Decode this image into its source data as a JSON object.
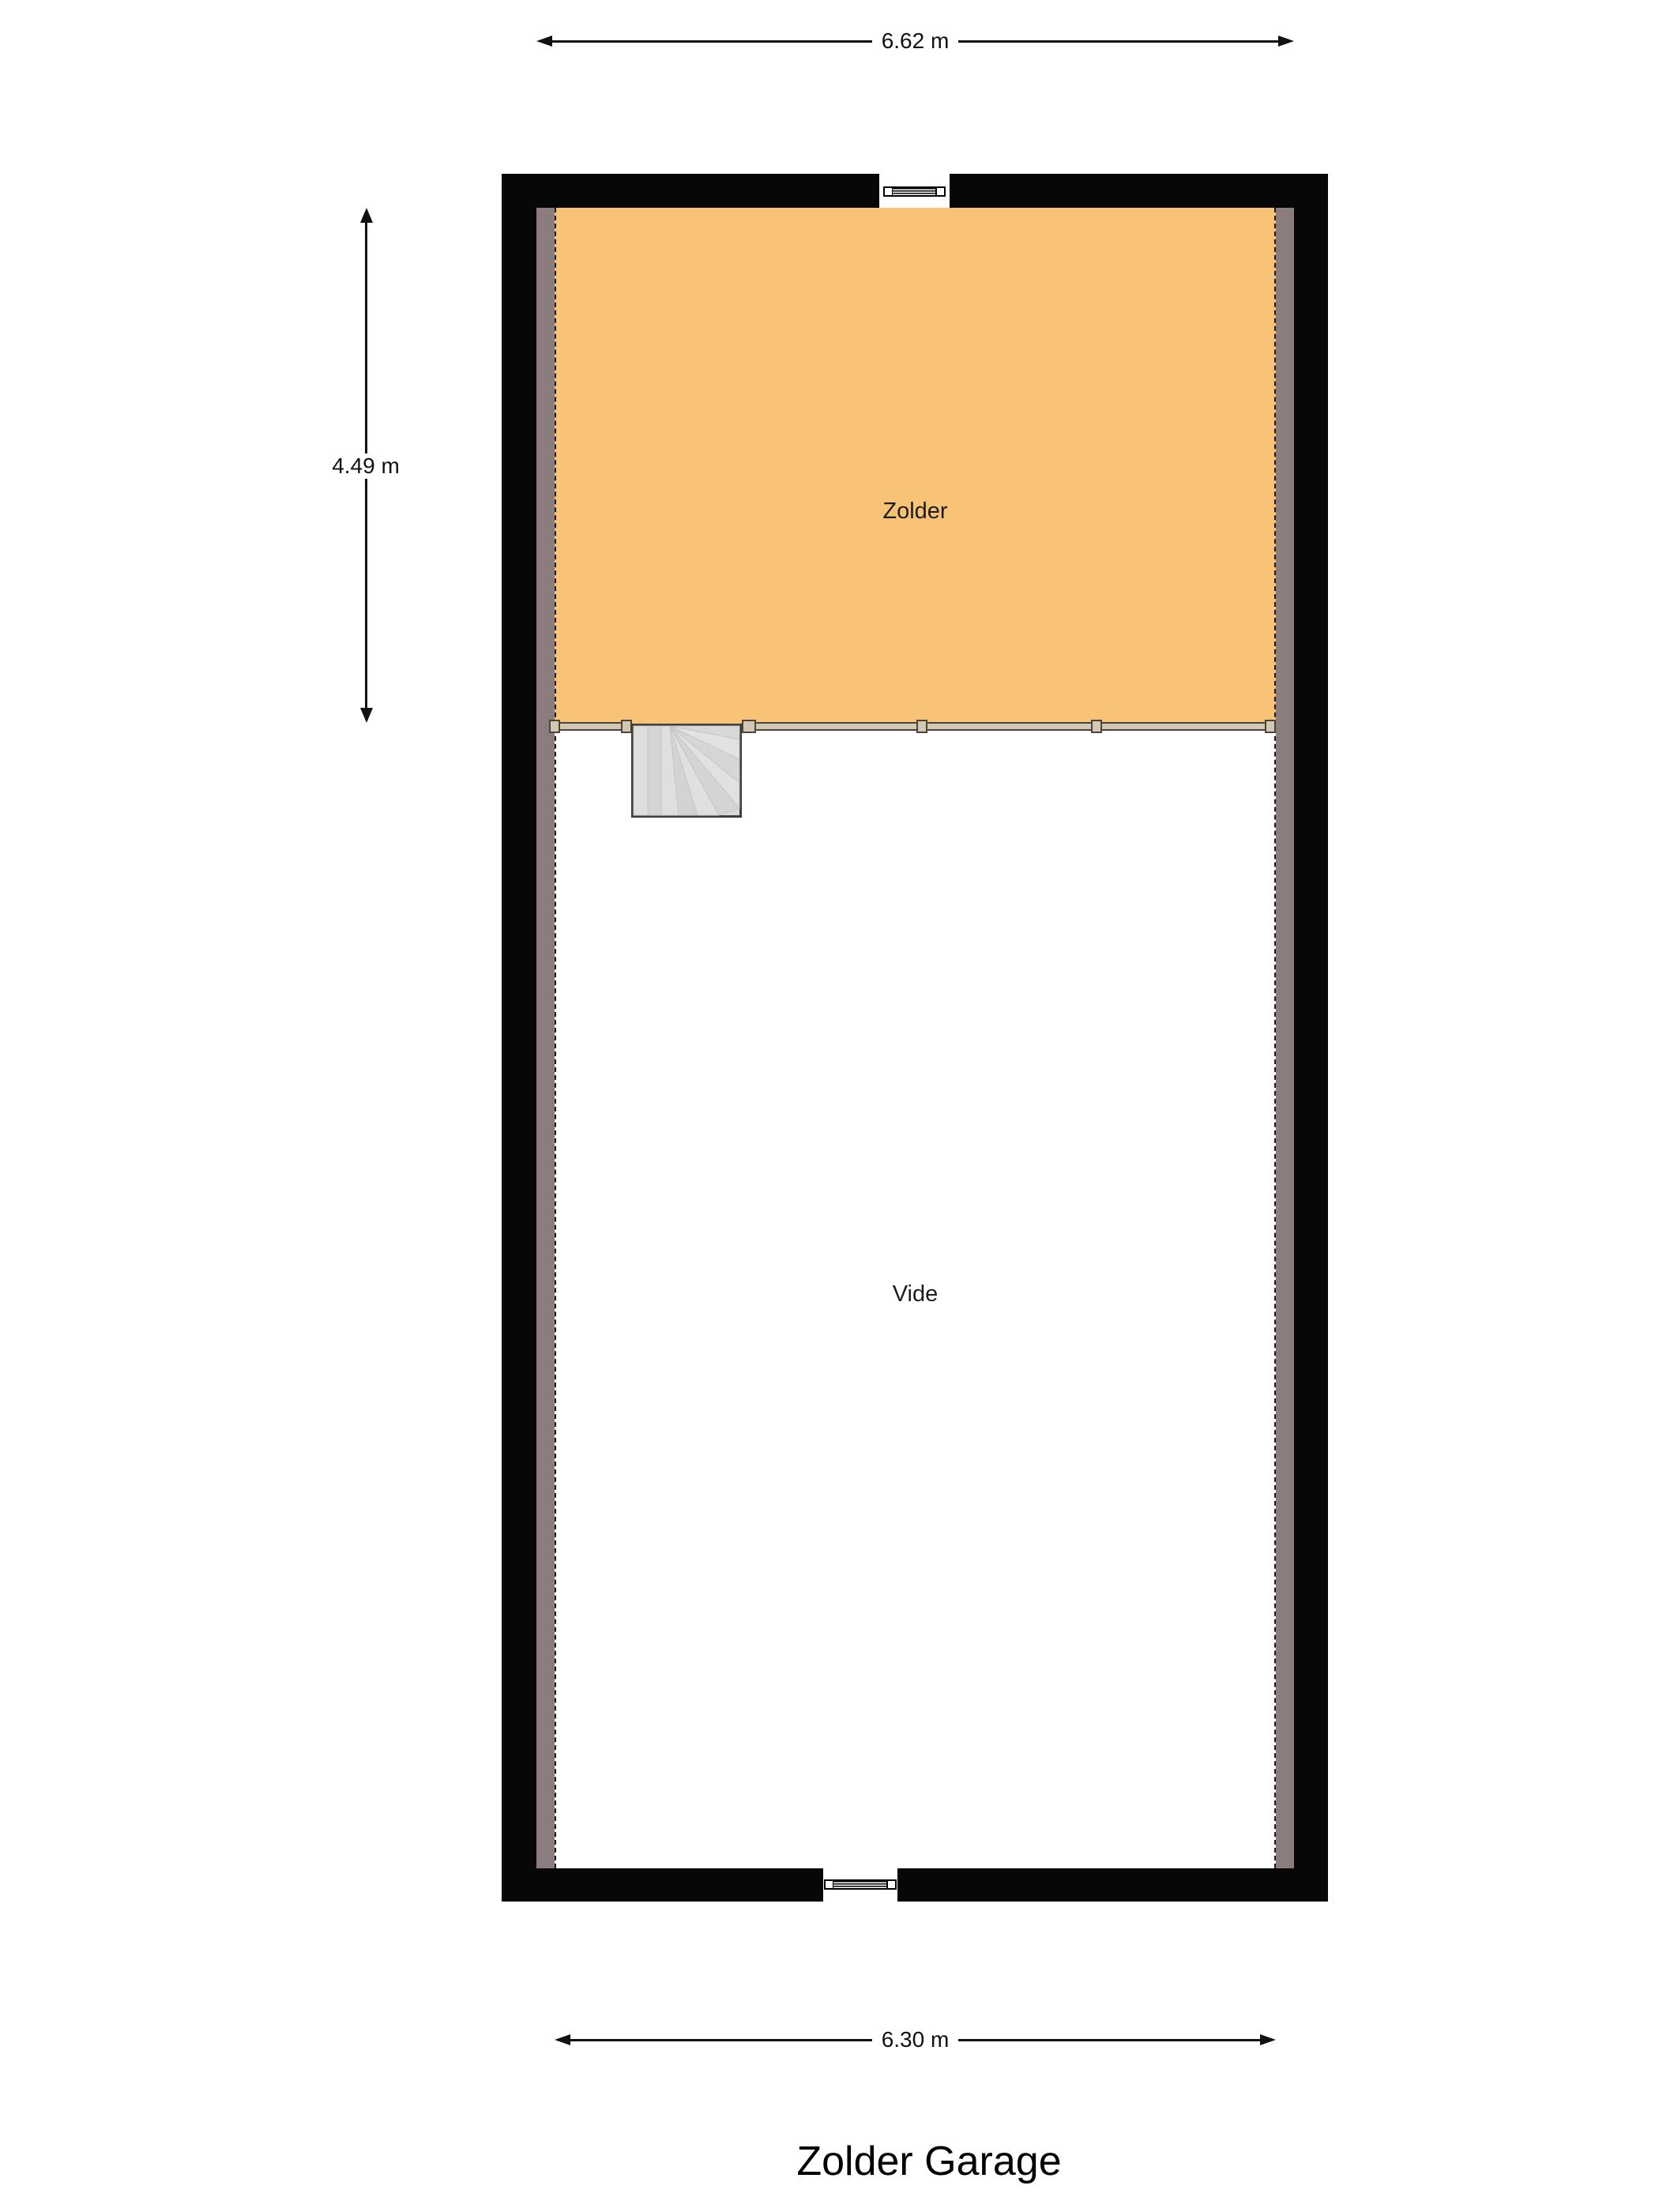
{
  "title": "Zolder Garage",
  "dimensions": {
    "top": {
      "label": "6.62 m"
    },
    "left": {
      "label": "4.49 m"
    },
    "bottom": {
      "label": "6.30 m"
    }
  },
  "rooms": {
    "zolder": {
      "label": "Zolder",
      "fill": "#f8c377"
    },
    "vide": {
      "label": "Vide",
      "fill": "#ffffff"
    }
  },
  "colors": {
    "wall": "#070707",
    "wall_lining": "#8b7c7d",
    "stairs_fill": "#d9d9d9",
    "stairs_border": "#3d3d3d",
    "railing_fill": "#d3c8b2",
    "railing_border": "#4a443c",
    "dimension_line": "#111111",
    "label_text": "#1c1c1c"
  }
}
